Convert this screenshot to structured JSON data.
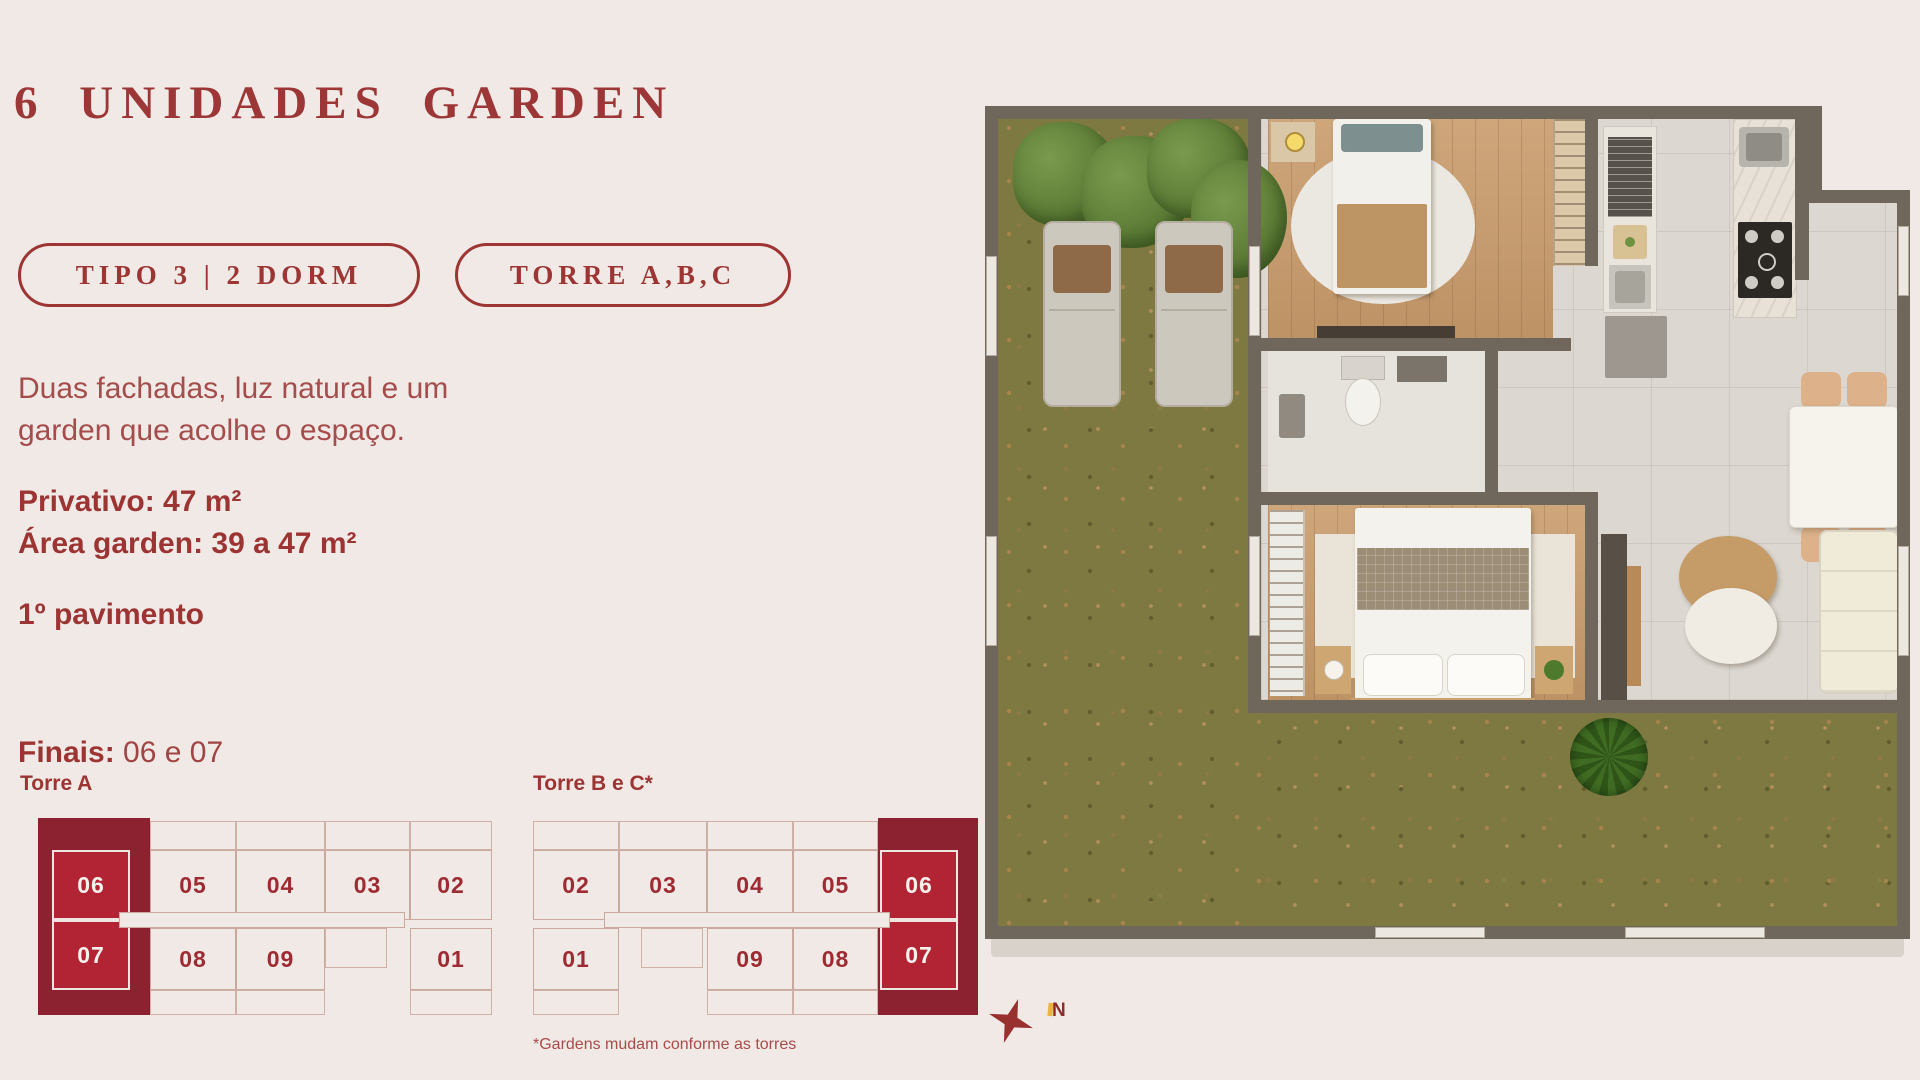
{
  "title": "6 UNIDADES GARDEN",
  "badges": {
    "tipo": "TIPO 3 | 2 DORM",
    "torre": "TORRE A,B,C"
  },
  "description": {
    "line1": "Duas fachadas, luz natural e um",
    "line2": "garden que acolhe o espaço."
  },
  "specs": {
    "privativo": "Privativo: 47 m²",
    "garden": "Área garden: 39 a 47 m²",
    "pavimento": "1º pavimento",
    "finais_label": "Finais:",
    "finais_value": "06 e 07"
  },
  "keyplans": {
    "torre_a": {
      "title": "Torre A",
      "top_row": [
        "06",
        "05",
        "04",
        "03",
        "02"
      ],
      "bottom_row": [
        "07",
        "08",
        "09",
        "01"
      ],
      "highlighted_units": [
        "06",
        "07"
      ]
    },
    "torre_bc": {
      "title": "Torre B e C*",
      "top_row": [
        "02",
        "03",
        "04",
        "05",
        "06"
      ],
      "bottom_row": [
        "01",
        "09",
        "08",
        "07"
      ],
      "highlighted_units": [
        "06",
        "07"
      ]
    },
    "footnote": "*Gardens mudam conforme as torres"
  },
  "compass": {
    "north_label": "N"
  },
  "colors": {
    "page_background": "#f0e9e5",
    "brand_red": "#9d3535",
    "paragraph_red": "#a54c4c",
    "keyplan_garden_maroon": "#8c2130",
    "keyplan_highlight_red": "#b22334",
    "keyplan_outline": "#c9a89e",
    "plan_wall": "#6f675c",
    "plan_grass": "#7e7940",
    "plan_tile": "#dcd7d1",
    "plan_wood": "#c99c6c"
  }
}
